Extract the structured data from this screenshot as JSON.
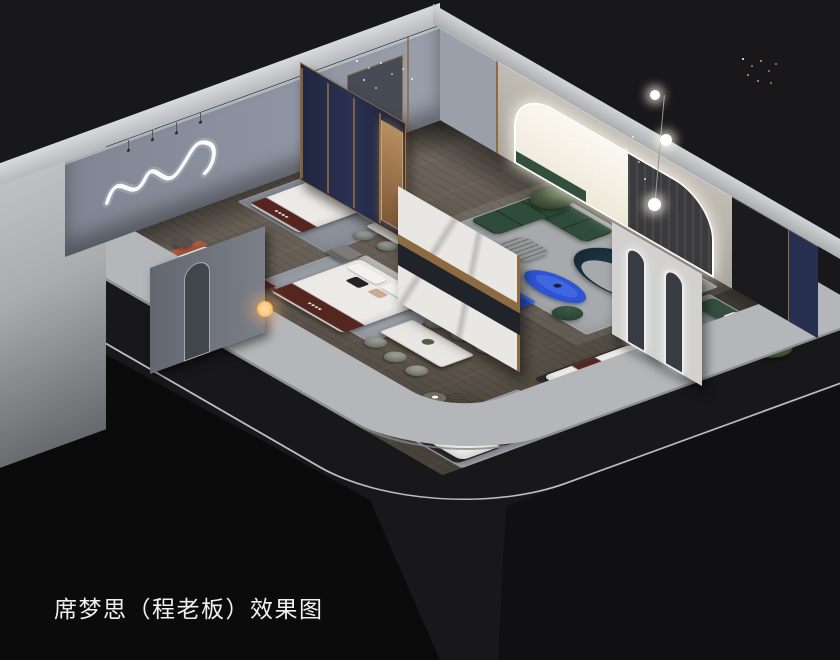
{
  "caption": {
    "text": "席梦思（程老板）效果图"
  },
  "scene": {
    "type": "isometric-interior-render",
    "description": "Cutaway 3D rendering of a Simmons mattress showroom with bedrooms, dining sets, living area and mattress displays",
    "rooms": [
      "left-bedroom",
      "center-bedroom",
      "dining-area",
      "living-room",
      "right-bedroom",
      "mattress-display-area"
    ],
    "objects": [
      "green-sectional-sofa",
      "teal-curved-sofa",
      "blue-coffee-table",
      "blue-media-bench",
      "striped-ottoman",
      "arched-led-wall",
      "bright-window",
      "dark-curtain",
      "navy-partition-panels",
      "marble-feature-wall",
      "arched-mirror-partition",
      "double-bed",
      "burgundy-bed-runner",
      "nightstands",
      "dining-table-six-chairs",
      "dining-table-four-chairs",
      "mauve-bench",
      "terracotta-bed",
      "mattress-displays",
      "swivel-armchairs",
      "potted-plants",
      "floor-lamp-globes",
      "squiggle-neon-wall-light",
      "crystal-chandelier-sparkles",
      "copper-string-lights",
      "bedside-glow-lamp"
    ]
  },
  "colors": {
    "bg": "#18181a",
    "band": "#b4b6ba",
    "bandlite": "#cdcfd2",
    "wood": "#5c554d",
    "woodlite": "#6e665c",
    "wooddark": "#474239",
    "wallnw": "#8d93a0",
    "wallne": "#b3afa7",
    "walldark": "#1b1b1e",
    "navy": "#273050",
    "brass": "#8d6a42",
    "marble": "#e9e7e3",
    "white": "#eceae6",
    "green": "#2f4c3a",
    "teal": "#132430",
    "blue": "#2e54d6",
    "blue2": "#2a4bc8",
    "burgundy": "#552620",
    "terracotta": "#ad5a3c",
    "pink": "#9c6a70",
    "rug": "#a7aaad",
    "glow": "#ffc069",
    "led": "#ffffff",
    "caption": "#f1f1f1"
  }
}
